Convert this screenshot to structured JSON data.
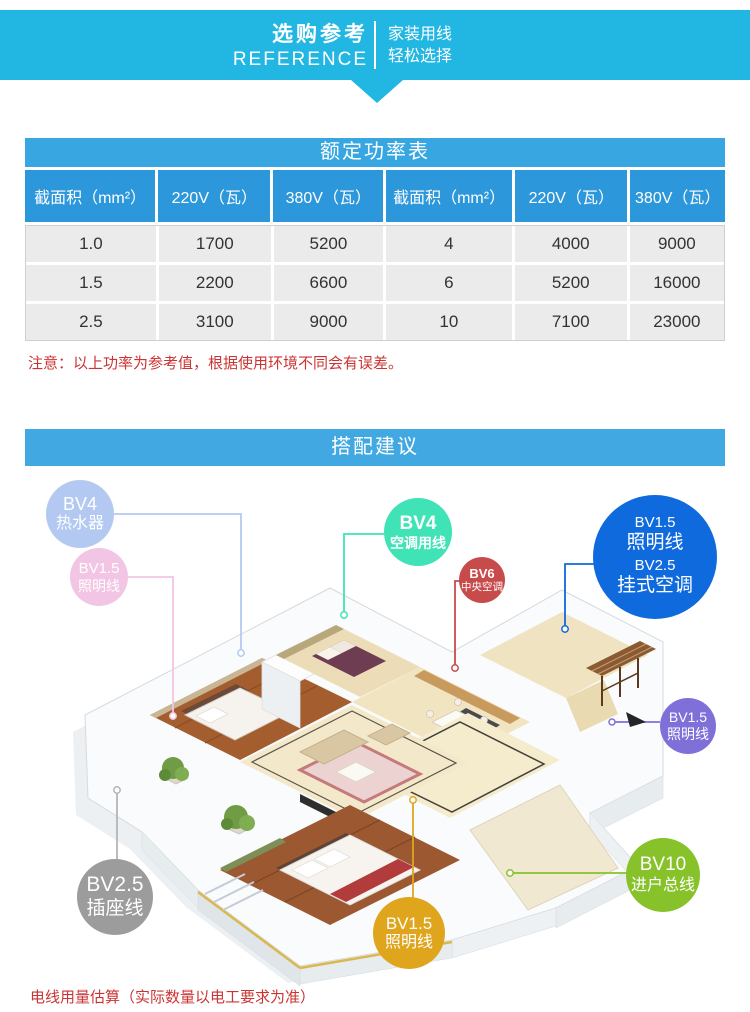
{
  "header": {
    "title_cn": "选购参考",
    "title_en": "REFERENCE",
    "tagline_line1": "家装用线",
    "tagline_line2": "轻松选择"
  },
  "power_table": {
    "title": "额定功率表",
    "columns": [
      "截面积（mm²）",
      "220V（瓦）",
      "380V（瓦）",
      "截面积（mm²）",
      "220V（瓦）",
      "380V（瓦）"
    ],
    "rows": [
      [
        "1.0",
        "1700",
        "5200",
        "4",
        "4000",
        "9000"
      ],
      [
        "1.5",
        "2200",
        "6600",
        "6",
        "5200",
        "16000"
      ],
      [
        "2.5",
        "3100",
        "9000",
        "10",
        "7100",
        "23000"
      ]
    ],
    "note": "注意：以上功率为参考值，根据使用环境不同会有误差。"
  },
  "suggestion": {
    "title": "搭配建议",
    "footnote": "电线用量估算（实际数量以电工要求为准）",
    "labels": [
      {
        "id": "water-heater",
        "lines": [
          "BV4",
          "热水器"
        ],
        "color": "#b4c9f2"
      },
      {
        "id": "lighting-pink",
        "lines": [
          "BV1.5",
          "照明线"
        ],
        "color": "#f3c5e4"
      },
      {
        "id": "ac-wire",
        "lines": [
          "BV4",
          "空调用线"
        ],
        "color": "#3fe3b5"
      },
      {
        "id": "central-ac",
        "lines": [
          "BV6",
          "中央空调"
        ],
        "color": "#c84b4b"
      },
      {
        "id": "lighting-and-wall-ac",
        "lines": [
          "BV1.5",
          "照明线",
          "BV2.5",
          "挂式空调"
        ],
        "color": "#0f6ade"
      },
      {
        "id": "lighting-purple",
        "lines": [
          "BV1.5",
          "照明线"
        ],
        "color": "#7e70d8"
      },
      {
        "id": "main-incoming",
        "lines": [
          "BV10",
          "进户总线"
        ],
        "color": "#88c22b"
      },
      {
        "id": "socket-wire",
        "lines": [
          "BV2.5",
          "插座线"
        ],
        "color": "#9c9c9c"
      },
      {
        "id": "lighting-gold",
        "lines": [
          "BV1.5",
          "照明线"
        ],
        "color": "#dfa51c"
      }
    ]
  },
  "colors": {
    "banner_cyan": "#22b7e3",
    "table_title_blue": "#38a7e1",
    "table_header_blue": "#2c97da",
    "table_cell_gray": "#ebebeb",
    "section_banner_blue": "#41a8e2",
    "note_red": "#cc3333"
  }
}
